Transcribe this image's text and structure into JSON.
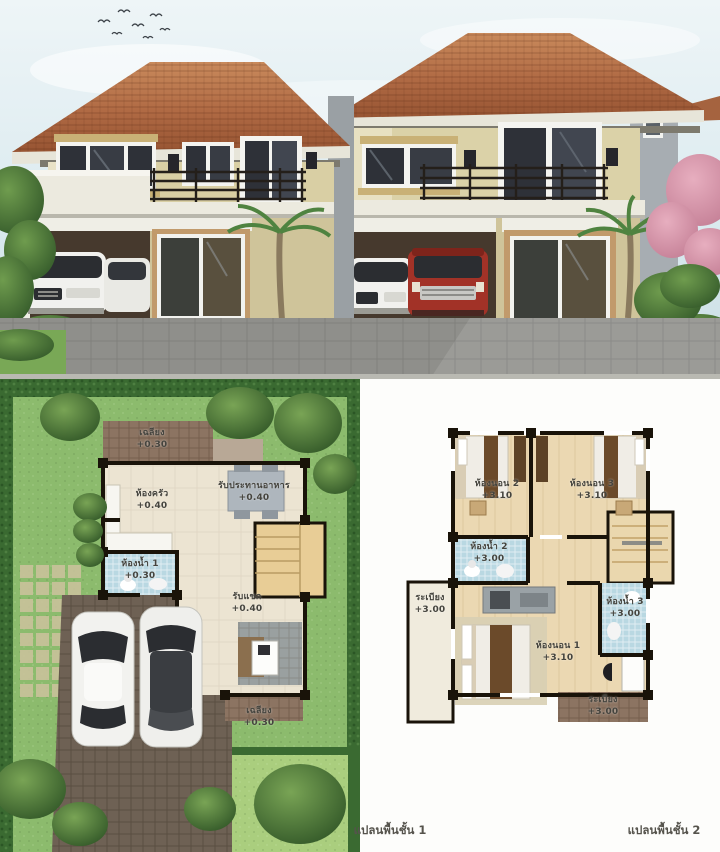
{
  "plan1": {
    "caption": "แปลนพื้นชั้น  1",
    "rooms": [
      {
        "label": "เฉลียง",
        "elevation": "+0.30"
      },
      {
        "label": "ห้องครัว",
        "elevation": "+0.40"
      },
      {
        "label": "รับประทานอาหาร",
        "elevation": "+0.40"
      },
      {
        "label": "ห้องน้ำ 1",
        "elevation": "+0.30"
      },
      {
        "label": "รับแขก",
        "elevation": "+0.40"
      },
      {
        "label": "เฉลียง",
        "elevation": "+0.30"
      }
    ]
  },
  "plan2": {
    "caption": "แปลนพื้นชั้น 2",
    "rooms": [
      {
        "label": "ห้องนอน 2",
        "elevation": "+3.10"
      },
      {
        "label": "ห้องนอน 3",
        "elevation": "+3.10"
      },
      {
        "label": "ห้องน้ำ 2",
        "elevation": "+3.00"
      },
      {
        "label": "ระเบียง",
        "elevation": "+3.00"
      },
      {
        "label": "ห้องนอน 1",
        "elevation": "+3.10"
      },
      {
        "label": "ห้องน้ำ 3",
        "elevation": "+3.00"
      },
      {
        "label": "ระเบียง",
        "elevation": "+3.00"
      }
    ]
  },
  "colors": {
    "roof": "#b06a44",
    "wall_cream": "#d9cfa4",
    "sky": "#e9f2f5",
    "lawn_site": "#8cbb6d",
    "hedge": "#3a6a31",
    "floor_cream": "#ece4d2",
    "floor_wood": "#ebd8b2",
    "tile_blue": "#b9d8e2",
    "porch_brown": "#8c7462",
    "driveway": "#6e6154",
    "wall_line": "#191309",
    "label_text": "#45443e",
    "suv_red": "#a23227"
  }
}
